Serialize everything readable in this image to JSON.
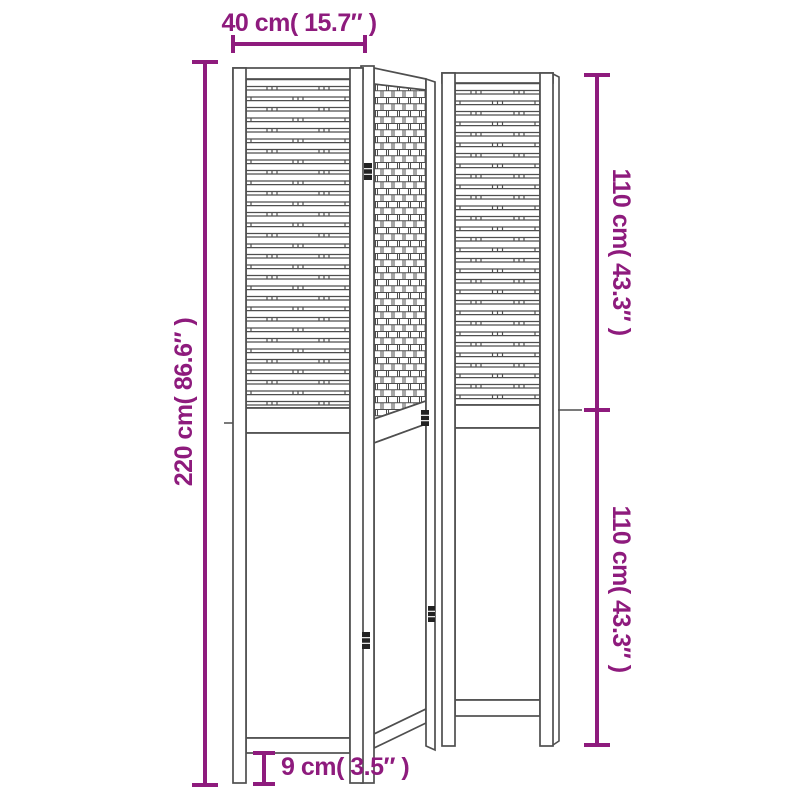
{
  "diagram": {
    "type": "product-dimension-diagram",
    "subject": "folding room divider with 3 woven wood panels",
    "panel_count": 3,
    "labels": {
      "overall_width": "40 cm( 15.7″ )",
      "overall_height": "220 cm( 86.6″ )",
      "upper_section_height": "110 cm( 43.3″ )",
      "lower_section_height": "110 cm( 43.3″ )",
      "foot_height": "9 cm( 3.5″ )"
    },
    "measurements": {
      "overall_width_cm": 40,
      "overall_width_in": 15.7,
      "overall_height_cm": 220,
      "overall_height_in": 86.6,
      "upper_section_cm": 110,
      "upper_section_in": 43.3,
      "lower_section_cm": 110,
      "lower_section_in": 43.3,
      "foot_height_cm": 9,
      "foot_height_in": 3.5
    },
    "colors": {
      "dimension": "#8e1b7d",
      "drawing": "#4f4f4f",
      "hinge": "#222222",
      "background": "#ffffff"
    }
  }
}
